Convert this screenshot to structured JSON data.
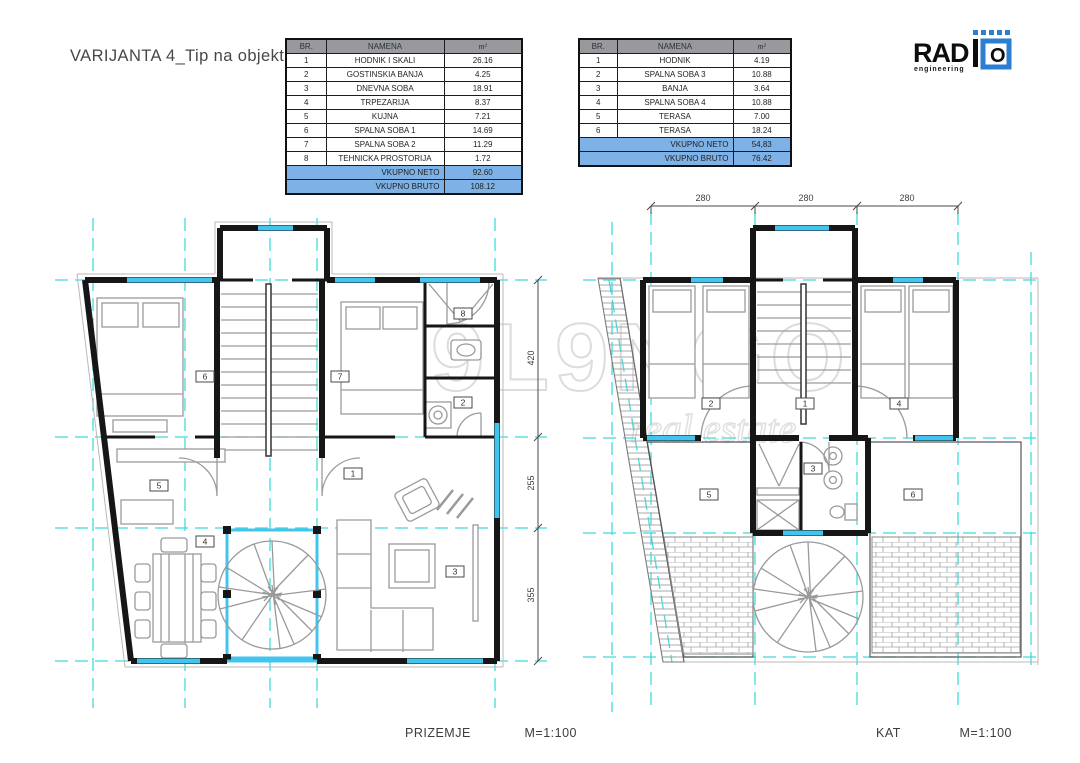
{
  "title": "VARIJANTA 4_Tip na objekt E",
  "logo": {
    "name": "RAD",
    "o": "O",
    "tagline": "engineering"
  },
  "watermark": {
    "line1": "M9L9NGO",
    "line2": "real estate"
  },
  "tables": {
    "left": {
      "headers": [
        "BR.",
        "NAMENA",
        "m²"
      ],
      "rows": [
        [
          "1",
          "HODNIK I SKALI",
          "26.16"
        ],
        [
          "2",
          "GOSTINSKIA BANJA",
          "4.25"
        ],
        [
          "3",
          "DNEVNA SOBA",
          "18.91"
        ],
        [
          "4",
          "TRPEZARIJA",
          "8.37"
        ],
        [
          "5",
          "KUJNA",
          "7.21"
        ],
        [
          "6",
          "SPALNA SOBA 1",
          "14.69"
        ],
        [
          "7",
          "SPALNA SOBA 2",
          "11.29"
        ],
        [
          "8",
          "TEHNICKA PROSTORIJA",
          "1.72"
        ]
      ],
      "totals": [
        [
          "VKUPNO NETO",
          "92.60"
        ],
        [
          "VKUPNO BRUTO",
          "108.12"
        ]
      ]
    },
    "right": {
      "headers": [
        "BR.",
        "NAMENA",
        "m²"
      ],
      "rows": [
        [
          "1",
          "HODNIK",
          "4.19"
        ],
        [
          "2",
          "SPALNA SOBA 3",
          "10.88"
        ],
        [
          "3",
          "BANJA",
          "3.64"
        ],
        [
          "4",
          "SPALNA SOBA 4",
          "10.88"
        ],
        [
          "5",
          "TERASA",
          "7.00"
        ],
        [
          "6",
          "TERASA",
          "18.24"
        ]
      ],
      "totals": [
        [
          "VKUPNO NETO",
          "54,83"
        ],
        [
          "VKUPNO BRUTO",
          "76.42"
        ]
      ]
    }
  },
  "plans": {
    "prizemje": {
      "caption": "PRIZEMJE",
      "scale": "M=1:100",
      "room_labels": [
        "6",
        "7",
        "8",
        "2",
        "5",
        "4",
        "1",
        "3"
      ],
      "side_dims": [
        "420",
        "255",
        "355"
      ]
    },
    "kat": {
      "caption": "KAT",
      "scale": "M=1:100",
      "room_labels": [
        "2",
        "1",
        "4",
        "5",
        "3",
        "6"
      ],
      "top_dims": [
        "280",
        "280",
        "280"
      ]
    }
  },
  "colors": {
    "total_row_blue": "#7eb1e6",
    "header_gray": "#97999c",
    "grid_cyan": "#3fdbdb",
    "window_cyan": "#42c4ee",
    "wall_black": "#161616",
    "logo_blue": "#2b7fd0"
  }
}
